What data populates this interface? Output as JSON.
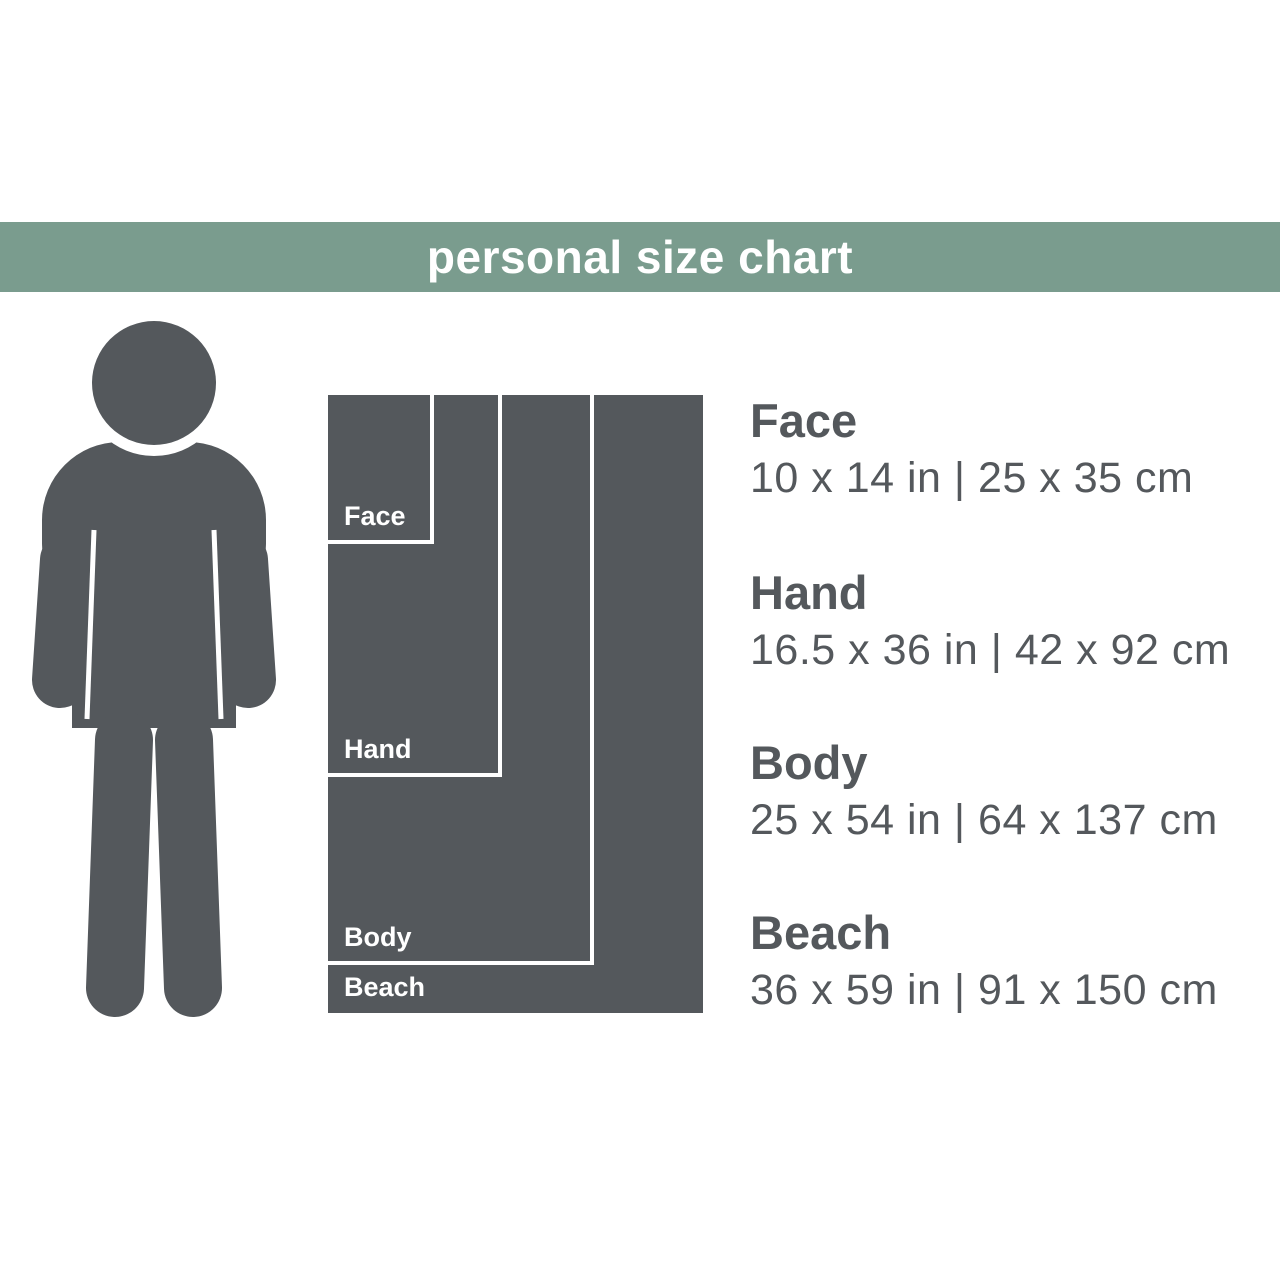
{
  "header": {
    "title": "personal size chart"
  },
  "colors": {
    "header_bg": "#7a9c8e",
    "silhouette_and_block": "#54585c",
    "divider": "#ffffff",
    "background": "#ffffff"
  },
  "person": {
    "description": "human figure silhouette shown for scale"
  },
  "sizes": [
    {
      "name": "Face",
      "box_label": "Face",
      "inches": "10 x 14 in",
      "centimeters": "25 x 35 cm",
      "dimensions": "10 x 14 in | 25 x 35 cm"
    },
    {
      "name": "Hand",
      "box_label": "Hand",
      "inches": "16.5 x 36 in",
      "centimeters": "42 x 92 cm",
      "dimensions": "16.5 x 36 in | 42 x 92 cm"
    },
    {
      "name": "Body",
      "box_label": "Body",
      "inches": "25 x 54 in",
      "centimeters": "64 x 137 cm",
      "dimensions": "25 x 54 in | 64 x 137 cm"
    },
    {
      "name": "Beach",
      "box_label": "Beach",
      "inches": "36 x 59 in",
      "centimeters": "91 x 150 cm",
      "dimensions": "36 x 59 in | 91 x 150 cm"
    }
  ]
}
